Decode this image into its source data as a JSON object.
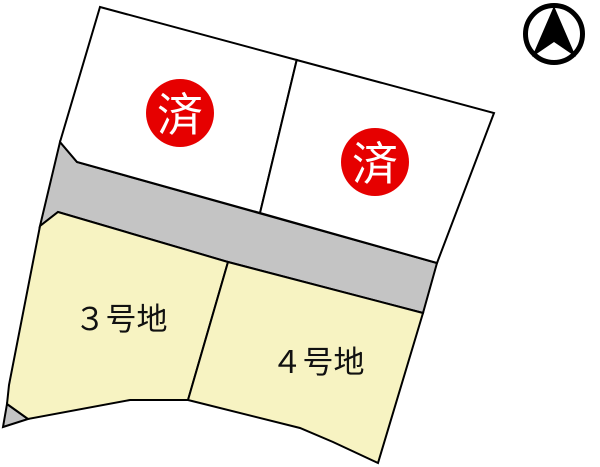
{
  "map": {
    "sold_badge_label": "済",
    "lots": [
      {
        "name": "lot-1",
        "status": "sold"
      },
      {
        "name": "lot-2",
        "status": "sold"
      },
      {
        "name": "lot-3",
        "label": "３号地",
        "status": "available"
      },
      {
        "name": "lot-4",
        "label": "４号地",
        "status": "available"
      }
    ],
    "icons": {
      "north": "north-arrow-icon"
    },
    "colors": {
      "sold_lot_fill": "#ffffff",
      "available_lot_fill": "#f7f3c2",
      "road_fill": "#c4c4c4",
      "sold_badge_fill": "#e60000",
      "badge_text": "#ffffff",
      "outline": "#000000",
      "background": "#ffffff"
    }
  }
}
